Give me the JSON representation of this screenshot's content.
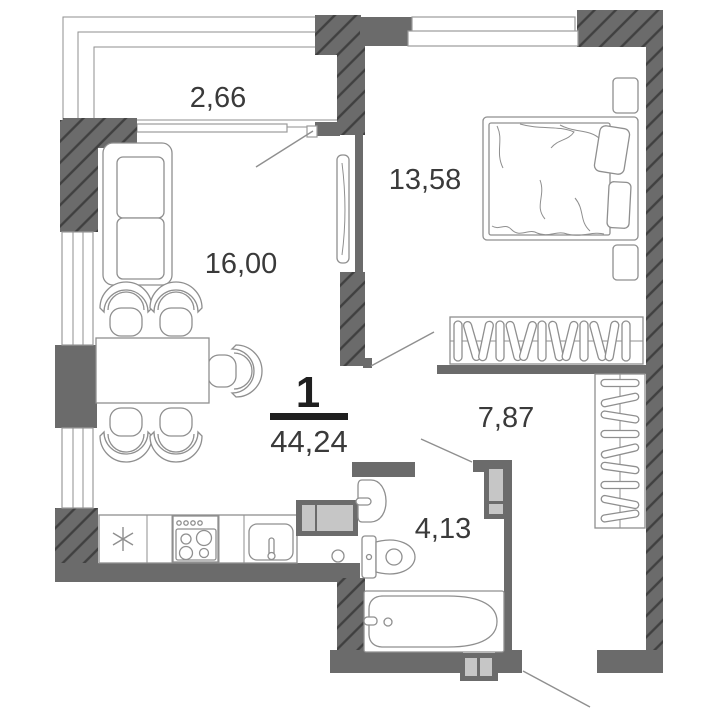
{
  "plan": {
    "rooms_count": "1",
    "total_area": "44,24",
    "room_areas": {
      "balcony": "2,66",
      "bedroom": "13,58",
      "living_kitchen": "16,00",
      "hallway": "7,87",
      "bathroom": "4,13"
    },
    "icons": {
      "fridge": "snowflake-icon"
    },
    "colors": {
      "wall": "#6b6b6b",
      "wall_hatch": "#404040",
      "furniture_line": "#8f8f8f",
      "appliance_fill": "#c6c6c6",
      "label_text": "#3a3a3a",
      "summary_text": "#1f1f1f",
      "background": "#ffffff"
    }
  }
}
